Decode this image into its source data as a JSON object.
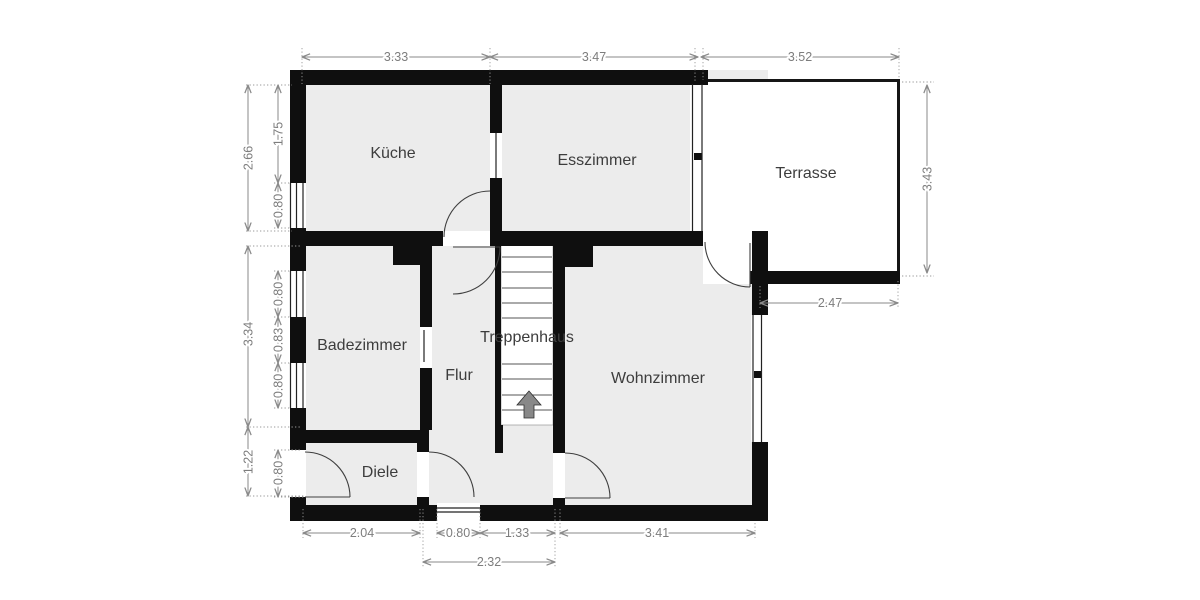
{
  "rooms": {
    "kueche": "Küche",
    "esszimmer": "Esszimmer",
    "terrasse": "Terrasse",
    "badezimmer": "Badezimmer",
    "treppenhaus": "Treppenhaus",
    "flur": "Flur",
    "wohnzimmer": "Wohnzimmer",
    "diele": "Diele"
  },
  "dims": {
    "top": [
      "3.33",
      "3.47",
      "3.52"
    ],
    "left_outer": [
      "2.66",
      "3.34",
      "1.22"
    ],
    "left_inner": [
      "1.75",
      "0.80",
      "0.80",
      "0.83",
      "0.80",
      "0.80"
    ],
    "right": [
      "3.43"
    ],
    "terrace_bottom": [
      "2.47"
    ],
    "bottom_row1": [
      "2.04",
      "0.80",
      "1.33",
      "3.41"
    ],
    "bottom_row2": [
      "2.32"
    ]
  },
  "icons": {
    "stairs_arrow": "up-arrow-icon"
  },
  "colors": {
    "wall": "#0f0f0f",
    "floor": "#ececec",
    "terrace": "#ffffff",
    "dimension": "#7d7d7d",
    "label": "#3d3d3d"
  }
}
